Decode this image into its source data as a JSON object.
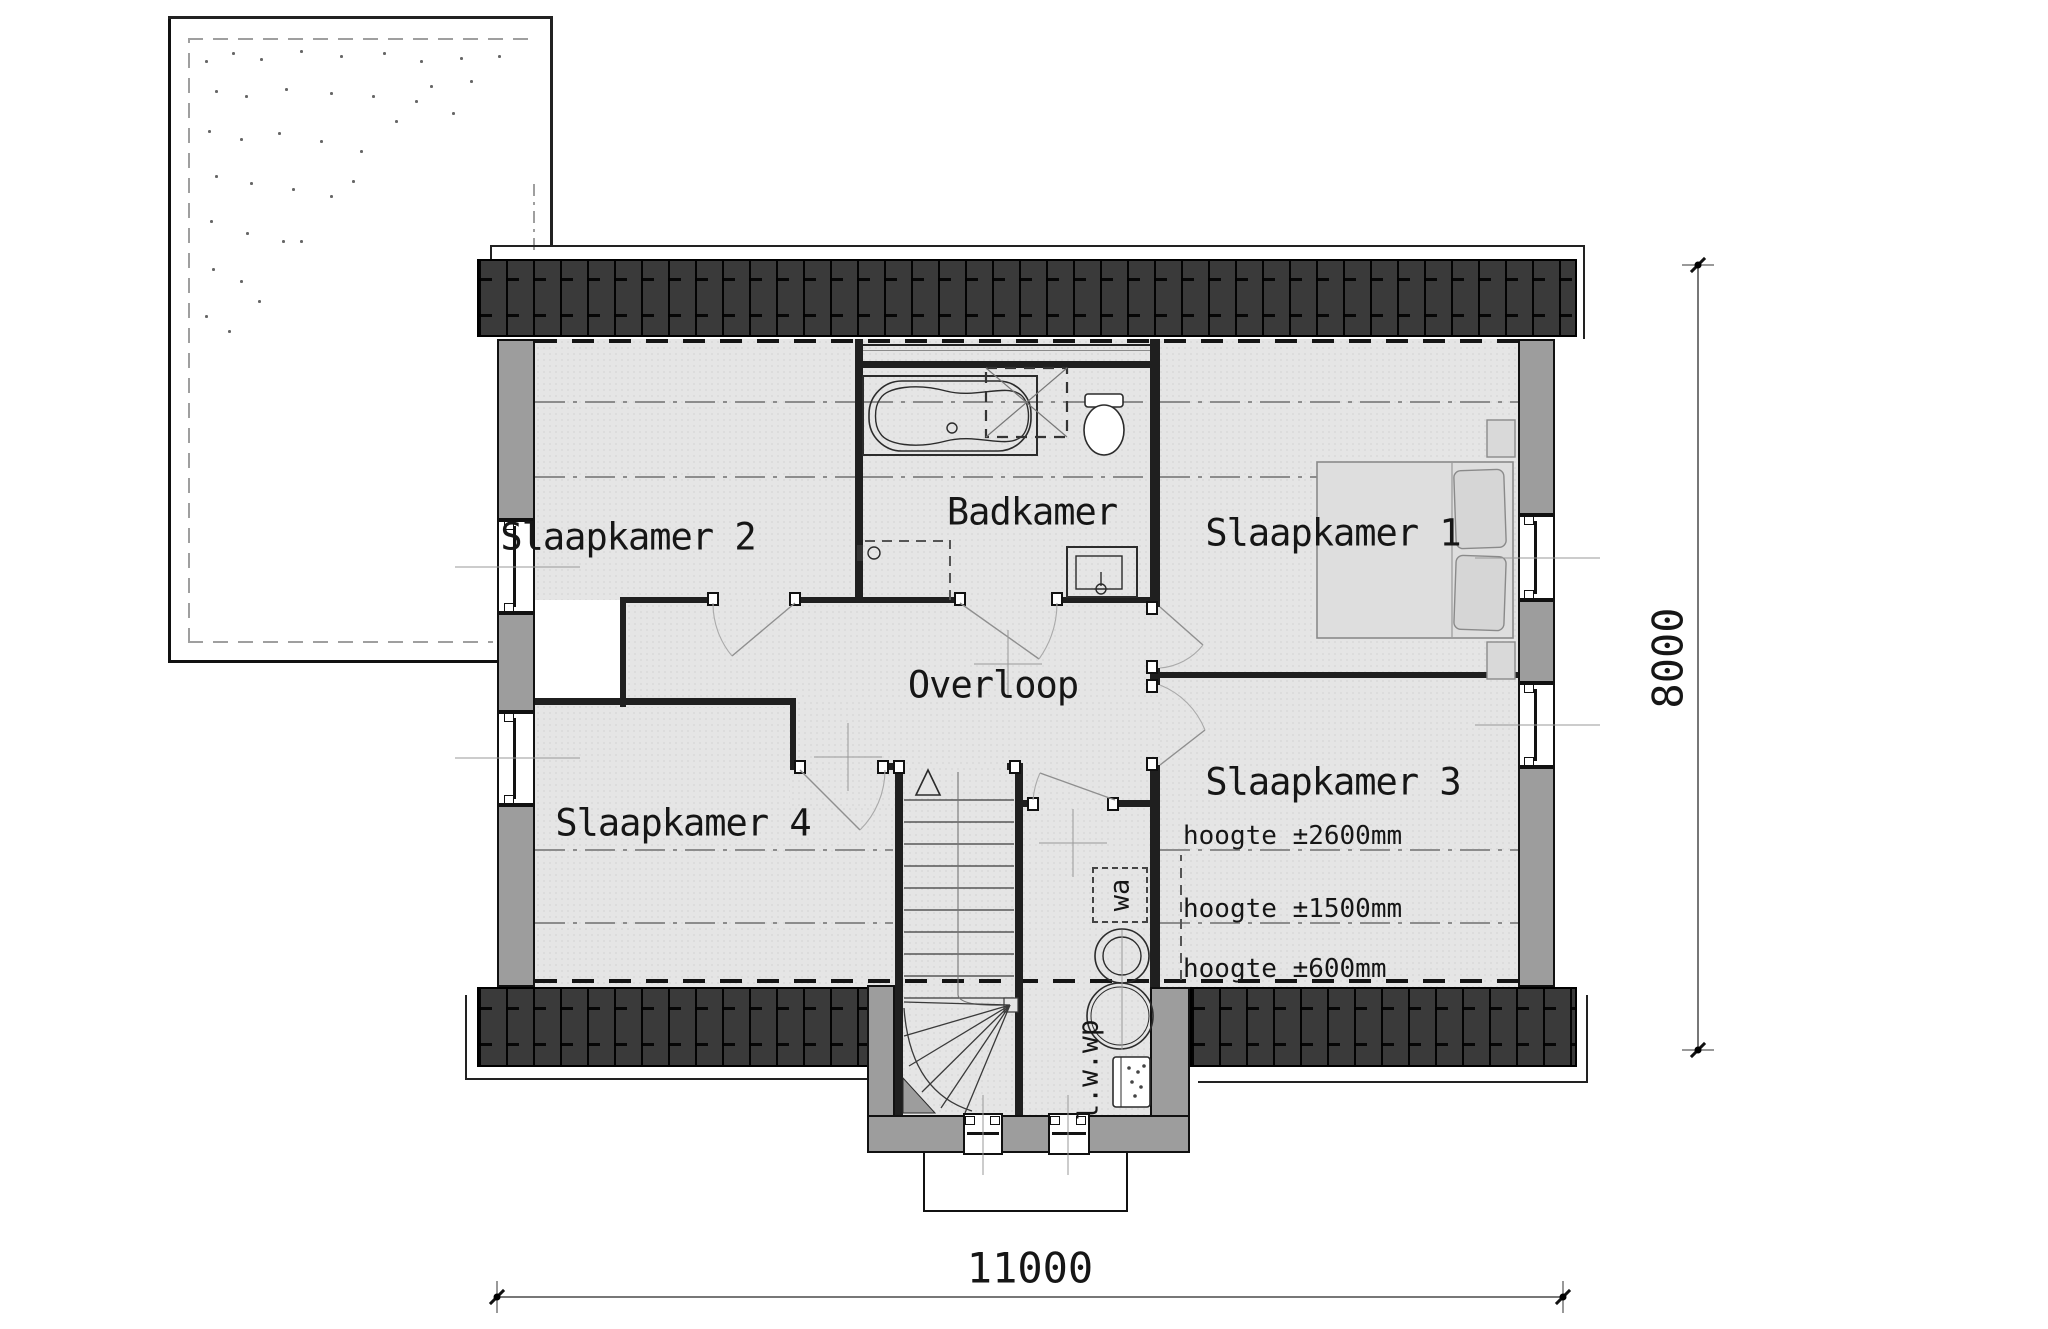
{
  "rooms": {
    "slaapkamer1": "Slaapkamer 1",
    "slaapkamer2": "Slaapkamer 2",
    "slaapkamer3": "Slaapkamer 3",
    "slaapkamer4": "Slaapkamer 4",
    "badkamer": "Badkamer",
    "overloop": "Overloop"
  },
  "annotations": {
    "hoogte_2600": "hoogte ±2600mm",
    "hoogte_1500": "hoogte ±1500mm",
    "hoogte_600": "hoogte ±600mm",
    "washing_machine": "wa",
    "heat_pump": "l.w.wp"
  },
  "dimensions": {
    "width_mm": "11000",
    "depth_mm": "8000"
  },
  "colors": {
    "roof_hatch": "#3a3a3a",
    "exterior_wall": "#9d9d9d",
    "interior_wall": "#1f1f1f",
    "floor": "#e5e5e5",
    "background": "#ffffff"
  }
}
